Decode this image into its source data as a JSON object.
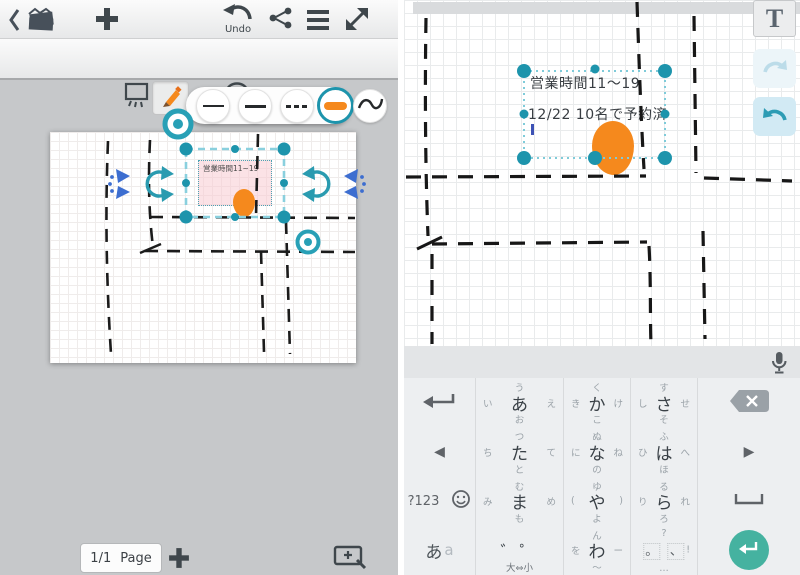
{
  "left_panel": {
    "toolbar_top": {
      "undo_label": "Undo",
      "icons": [
        "back-icon",
        "notes-stack-icon",
        "add-icon",
        "undo-icon",
        "share-icon",
        "menu-icon",
        "fullscreen-icon"
      ]
    },
    "toolbar_tools": {
      "tools": [
        "selection-mode",
        "pen",
        "eraser",
        "lasso",
        "text"
      ],
      "active_tool": "pen",
      "text_tool_label": "T"
    },
    "pen_popup": {
      "options": [
        "thin-line",
        "medium-line",
        "dotted-line",
        "thick-highlighter",
        "wave-line"
      ],
      "selected": "thick-highlighter",
      "selected_color": "#f5891d"
    },
    "canvas": {
      "textbox_text": "営業時間11~19",
      "accent_teal": "#1d94ac",
      "ink_color": "#1b1b1b",
      "blob_color": "#f5891d"
    },
    "page_bar": {
      "page_number": "1/1",
      "page_label": "Page"
    }
  },
  "right_panel": {
    "text_tool_label": "T",
    "note": {
      "line1": "営業時間11〜19",
      "line2": "12/22 10名で予約済"
    },
    "keyboard": {
      "keys": {
        "a": {
          "center": "あ",
          "left": "い",
          "top": "う",
          "right": "え",
          "bottom": "お"
        },
        "ka": {
          "center": "か",
          "left": "き",
          "top": "く",
          "right": "け",
          "bottom": "こ"
        },
        "sa": {
          "center": "さ",
          "left": "し",
          "top": "す",
          "right": "せ",
          "bottom": "そ"
        },
        "ta": {
          "center": "た",
          "left": "ち",
          "top": "つ",
          "right": "て",
          "bottom": "と"
        },
        "na": {
          "center": "な",
          "left": "に",
          "top": "ぬ",
          "right": "ね",
          "bottom": "の"
        },
        "ha": {
          "center": "は",
          "left": "ひ",
          "top": "ふ",
          "right": "へ",
          "bottom": "ほ"
        },
        "ma": {
          "center": "ま",
          "left": "み",
          "top": "む",
          "right": "め",
          "bottom": "も"
        },
        "ya": {
          "center": "や",
          "left": "(",
          "top": "ゆ",
          "right": ")",
          "bottom": "よ"
        },
        "ra": {
          "center": "ら",
          "left": "り",
          "top": "る",
          "right": "れ",
          "bottom": "ろ"
        },
        "wa": {
          "center": "わ",
          "left": "を",
          "top": "ん",
          "right": "ー",
          "bottom": "〜"
        },
        "symbols_label": "?123",
        "mode": {
          "primary": "あ",
          "secondary": "a"
        },
        "dakuten": {
          "center": "゛゜",
          "bottom": "大⇔小"
        },
        "punct": {
          "c1": "。",
          "c2": "、",
          "top": "?",
          "right": "!",
          "bottom": "…"
        }
      }
    }
  }
}
